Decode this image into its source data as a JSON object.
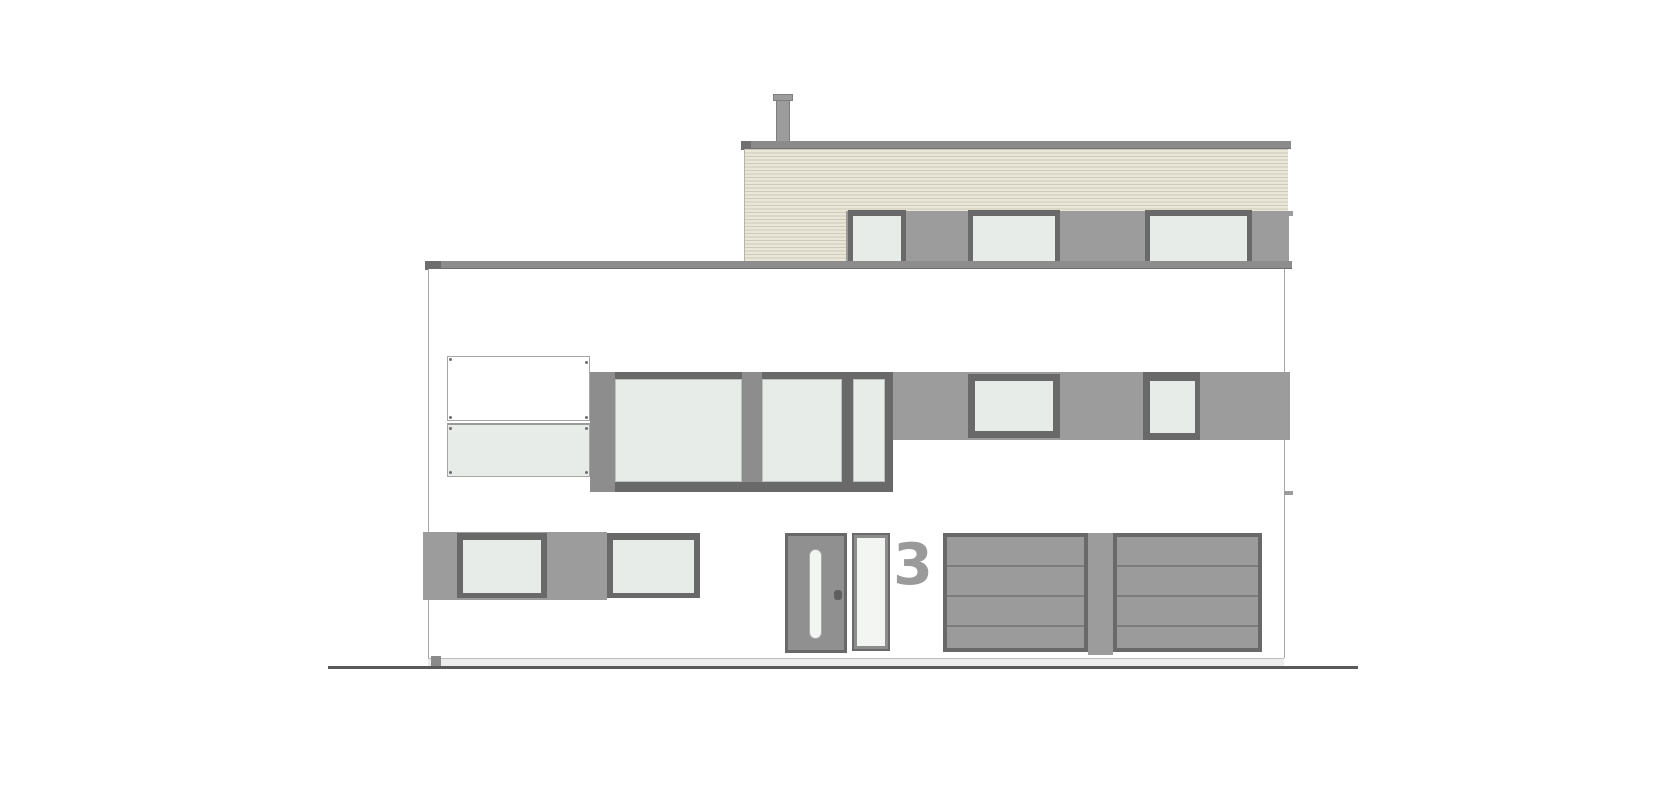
{
  "drawing": {
    "title": "house-front-elevation",
    "house_number": "3"
  },
  "colors": {
    "background": "#ffffff",
    "roof_cap": "#8b8b8b",
    "roof_cap_edge": "#707070",
    "chimney": "#9c9c9c",
    "chimney_edge": "#7f7f7f",
    "cladding_base": "#eae6d9",
    "cladding_stripe": "#cfc9b8",
    "cladding_edge": "#b9b3a2",
    "band_gray": "#9c9c9c",
    "eave_strip": "#8d8d8d",
    "eave_edge": "#6e6e6e",
    "frame_dark": "#696969",
    "frame_mid": "#8d8d8d",
    "glass": "#e8ece9",
    "glass_edge": "#bcc1bd",
    "wall_edge": "#a6a6a6",
    "door_leaf": "#909090",
    "door_slot": "#f3f5f2",
    "handle": "#5f5f5f",
    "garage_fill": "#9b9b9b",
    "garage_slat": "#7c7c7c",
    "divider": "#9c9c9c",
    "plinth": "#ededed",
    "plinth_edge": "#bdbdbd",
    "plinth_block": "#8a8a8a",
    "ground": "#5a5a5a",
    "number": "#9a9a9a"
  }
}
